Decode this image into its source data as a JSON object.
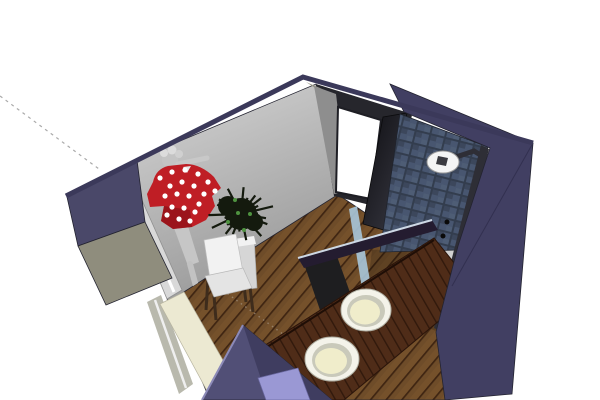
{
  "app": {
    "type": "3d-model-viewport",
    "description": "SketchUp-style perspective render of a bathroom interior model on a white canvas, viewed from above the front-left corner with section-cut walls"
  },
  "scene": {
    "objects": [
      {
        "name": "construction-guide-line",
        "desc": "gray dashed inference guide running from upper-left edge of canvas to the outer wall corner"
      },
      {
        "name": "left-wall-mural",
        "desc": "light gray interior wall with grayscale pin-up figure wallpaper"
      },
      {
        "name": "polka-dot-garment",
        "desc": "red garment with white polka dots hanging on the left wall"
      },
      {
        "name": "leaning-panel",
        "desc": "tall light gray panel/mirror leaning along the lower left wall"
      },
      {
        "name": "potted-plant",
        "desc": "dark spiky plant with green highlights in a white square pot"
      },
      {
        "name": "white-chair",
        "desc": "white chair with dark wooden legs"
      },
      {
        "name": "doorway",
        "desc": "open white doorway in the back wall with dark frame"
      },
      {
        "name": "open-door",
        "desc": "dark door panel swung into the room"
      },
      {
        "name": "tiled-shower-wall",
        "desc": "dark blue-gray mosaic tiled shower wall"
      },
      {
        "name": "shower-head",
        "desc": "round white rain shower head on a dark wall pipe with a vertical mixer column"
      },
      {
        "name": "glass-screen",
        "desc": "glass shower screen indicated by light blue edges"
      },
      {
        "name": "vanity-counter",
        "desc": "dark reddish wood vanity counter running along the right wall"
      },
      {
        "name": "sink-basins",
        "desc": "two round cream basins with white rims set into the counter"
      },
      {
        "name": "wood-floor",
        "desc": "brown plank flooring laid diagonally"
      },
      {
        "name": "right-wall-outer",
        "desc": "large navy-purple outer face of the right wall"
      },
      {
        "name": "front-wall-section",
        "desc": "purple section-cut wedge of the removed front wall with a lavender recessed panel"
      }
    ],
    "colors": {
      "background": "#ffffff",
      "guideLine": "#aaaaaa",
      "floorGuide": "#a59482",
      "wallTopEdge": "#3b395a",
      "rightWallOuter": "#413f62",
      "rightWallCrease": "#323050",
      "leftCutNavy": "#4a4869",
      "leftCutOlive": "#8f8d7d",
      "creamCut": "#ece9d2",
      "grayCut": "#b9b9ad",
      "backWallGray": "#8e8e8e",
      "backWallOlive": "#9a9888",
      "doorFrameDark": "#26262c",
      "doorwayWhite": "#ffffff",
      "tileBase": "#333d4e",
      "tileFace": "#485670",
      "floorBase": "#6e4c29",
      "floorGap": "#3f2512",
      "floorLight": "#7a552e",
      "showerFloorShade": "#000000",
      "counterBase": "#4f2c18",
      "counterGap": "#31190c",
      "counterEdge": "#1f0e06",
      "barDark": "#241c30",
      "glassEdge": "#a9c6da",
      "pipeDark": "#2e2e36",
      "showerHead": "#f4f4f4",
      "showerHeadHub": "#3a3a40",
      "sinkRim": "#f4f3ea",
      "sinkRing": "#c9c9ba",
      "sinkBasin": "#f0edcb",
      "shirtRed": "#bf1e25",
      "shirtShadow": "#871016",
      "dotWhite": "#ffffff",
      "muralSkin": "#c4c4c4",
      "muralCurl": "#dcdcdc",
      "plantDark": "#141a0e",
      "plantGreen": "#4f9340",
      "potLight": "#d6d6d6",
      "potRim": "#f2f2f2",
      "chairWhite": "#f2f2f2",
      "chairSeat": "#e4e4e4",
      "chairLeg": "#3e2c1c",
      "panelLight": "#d9d9d9",
      "panelStripe": "#ffffff",
      "wedgePurple": "#514f76",
      "wedgeDark": "#3f3d60",
      "wedgeHighlight": "#8c8ab8",
      "lavenderPanel": "#9a98d4"
    },
    "garment": {
      "dots": [
        [
          160,
          178
        ],
        [
          172,
          172
        ],
        [
          185,
          170
        ],
        [
          198,
          174
        ],
        [
          208,
          182
        ],
        [
          215,
          191
        ],
        [
          170,
          186
        ],
        [
          182,
          182
        ],
        [
          194,
          186
        ],
        [
          204,
          194
        ],
        [
          165,
          196
        ],
        [
          177,
          194
        ],
        [
          189,
          196
        ],
        [
          199,
          204
        ],
        [
          172,
          207
        ],
        [
          184,
          208
        ],
        [
          195,
          212
        ],
        [
          179,
          219
        ],
        [
          190,
          221
        ],
        [
          167,
          215
        ]
      ],
      "dot_radius": 2.6
    },
    "plant": {
      "cx": 241,
      "cy": 214,
      "spikes": 26,
      "spike_len": 34,
      "green_dots": [
        [
          235,
          200
        ],
        [
          250,
          214
        ],
        [
          228,
          222
        ],
        [
          244,
          230
        ],
        [
          238,
          213
        ]
      ]
    }
  }
}
